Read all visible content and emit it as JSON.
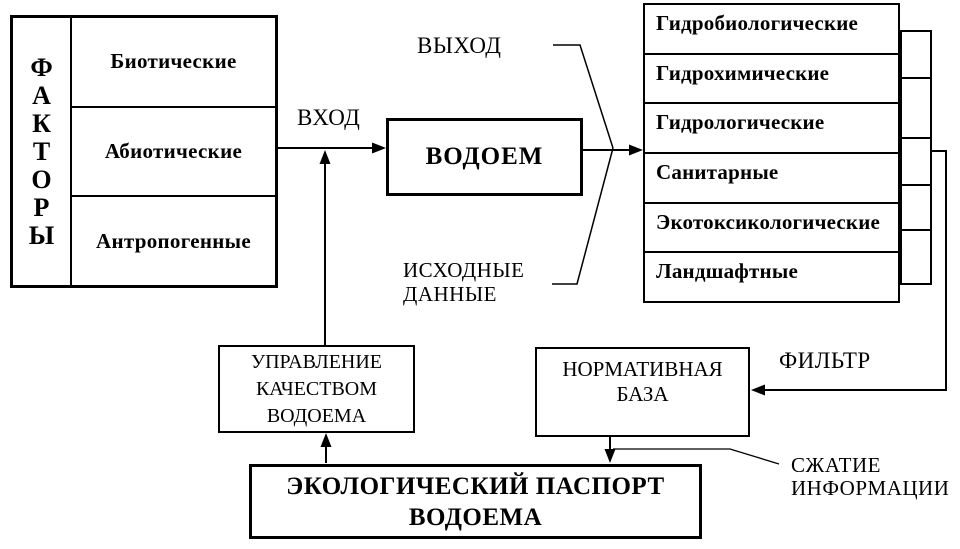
{
  "diagram": {
    "factors": {
      "word": "ФАКТОРЫ",
      "letters": [
        "Ф",
        "А",
        "К",
        "Т",
        "О",
        "Р",
        "Ы"
      ],
      "items": [
        "Биотические",
        "Абиотические",
        "Антропогенные"
      ]
    },
    "waterbody_label": "ВОДОЕМ",
    "indicators": [
      "Гидробиологические",
      "Гидрохимические",
      "Гидрологические",
      "Санитарные",
      "Экотоксикологические",
      "Ландшафтные"
    ],
    "labels": {
      "input": "ВХОД",
      "output": "ВЫХОД",
      "source_data": [
        "ИСХОДНЫЕ",
        "ДАННЫЕ"
      ],
      "filter": "ФИЛЬТР",
      "compression": [
        "СЖАТИЕ",
        "ИНФОРМАЦИИ"
      ]
    },
    "normative_base": [
      "НОРМАТИВНАЯ",
      "БАЗА"
    ],
    "management": [
      "УПРАВЛЕНИЕ",
      "КАЧЕСТВОМ",
      "ВОДОЕМА"
    ],
    "passport": [
      "ЭКОЛОГИЧЕСКИЙ ПАСПОРТ",
      "ВОДОЕМА"
    ],
    "colors": {
      "line": "#000000",
      "background": "#ffffff"
    }
  }
}
